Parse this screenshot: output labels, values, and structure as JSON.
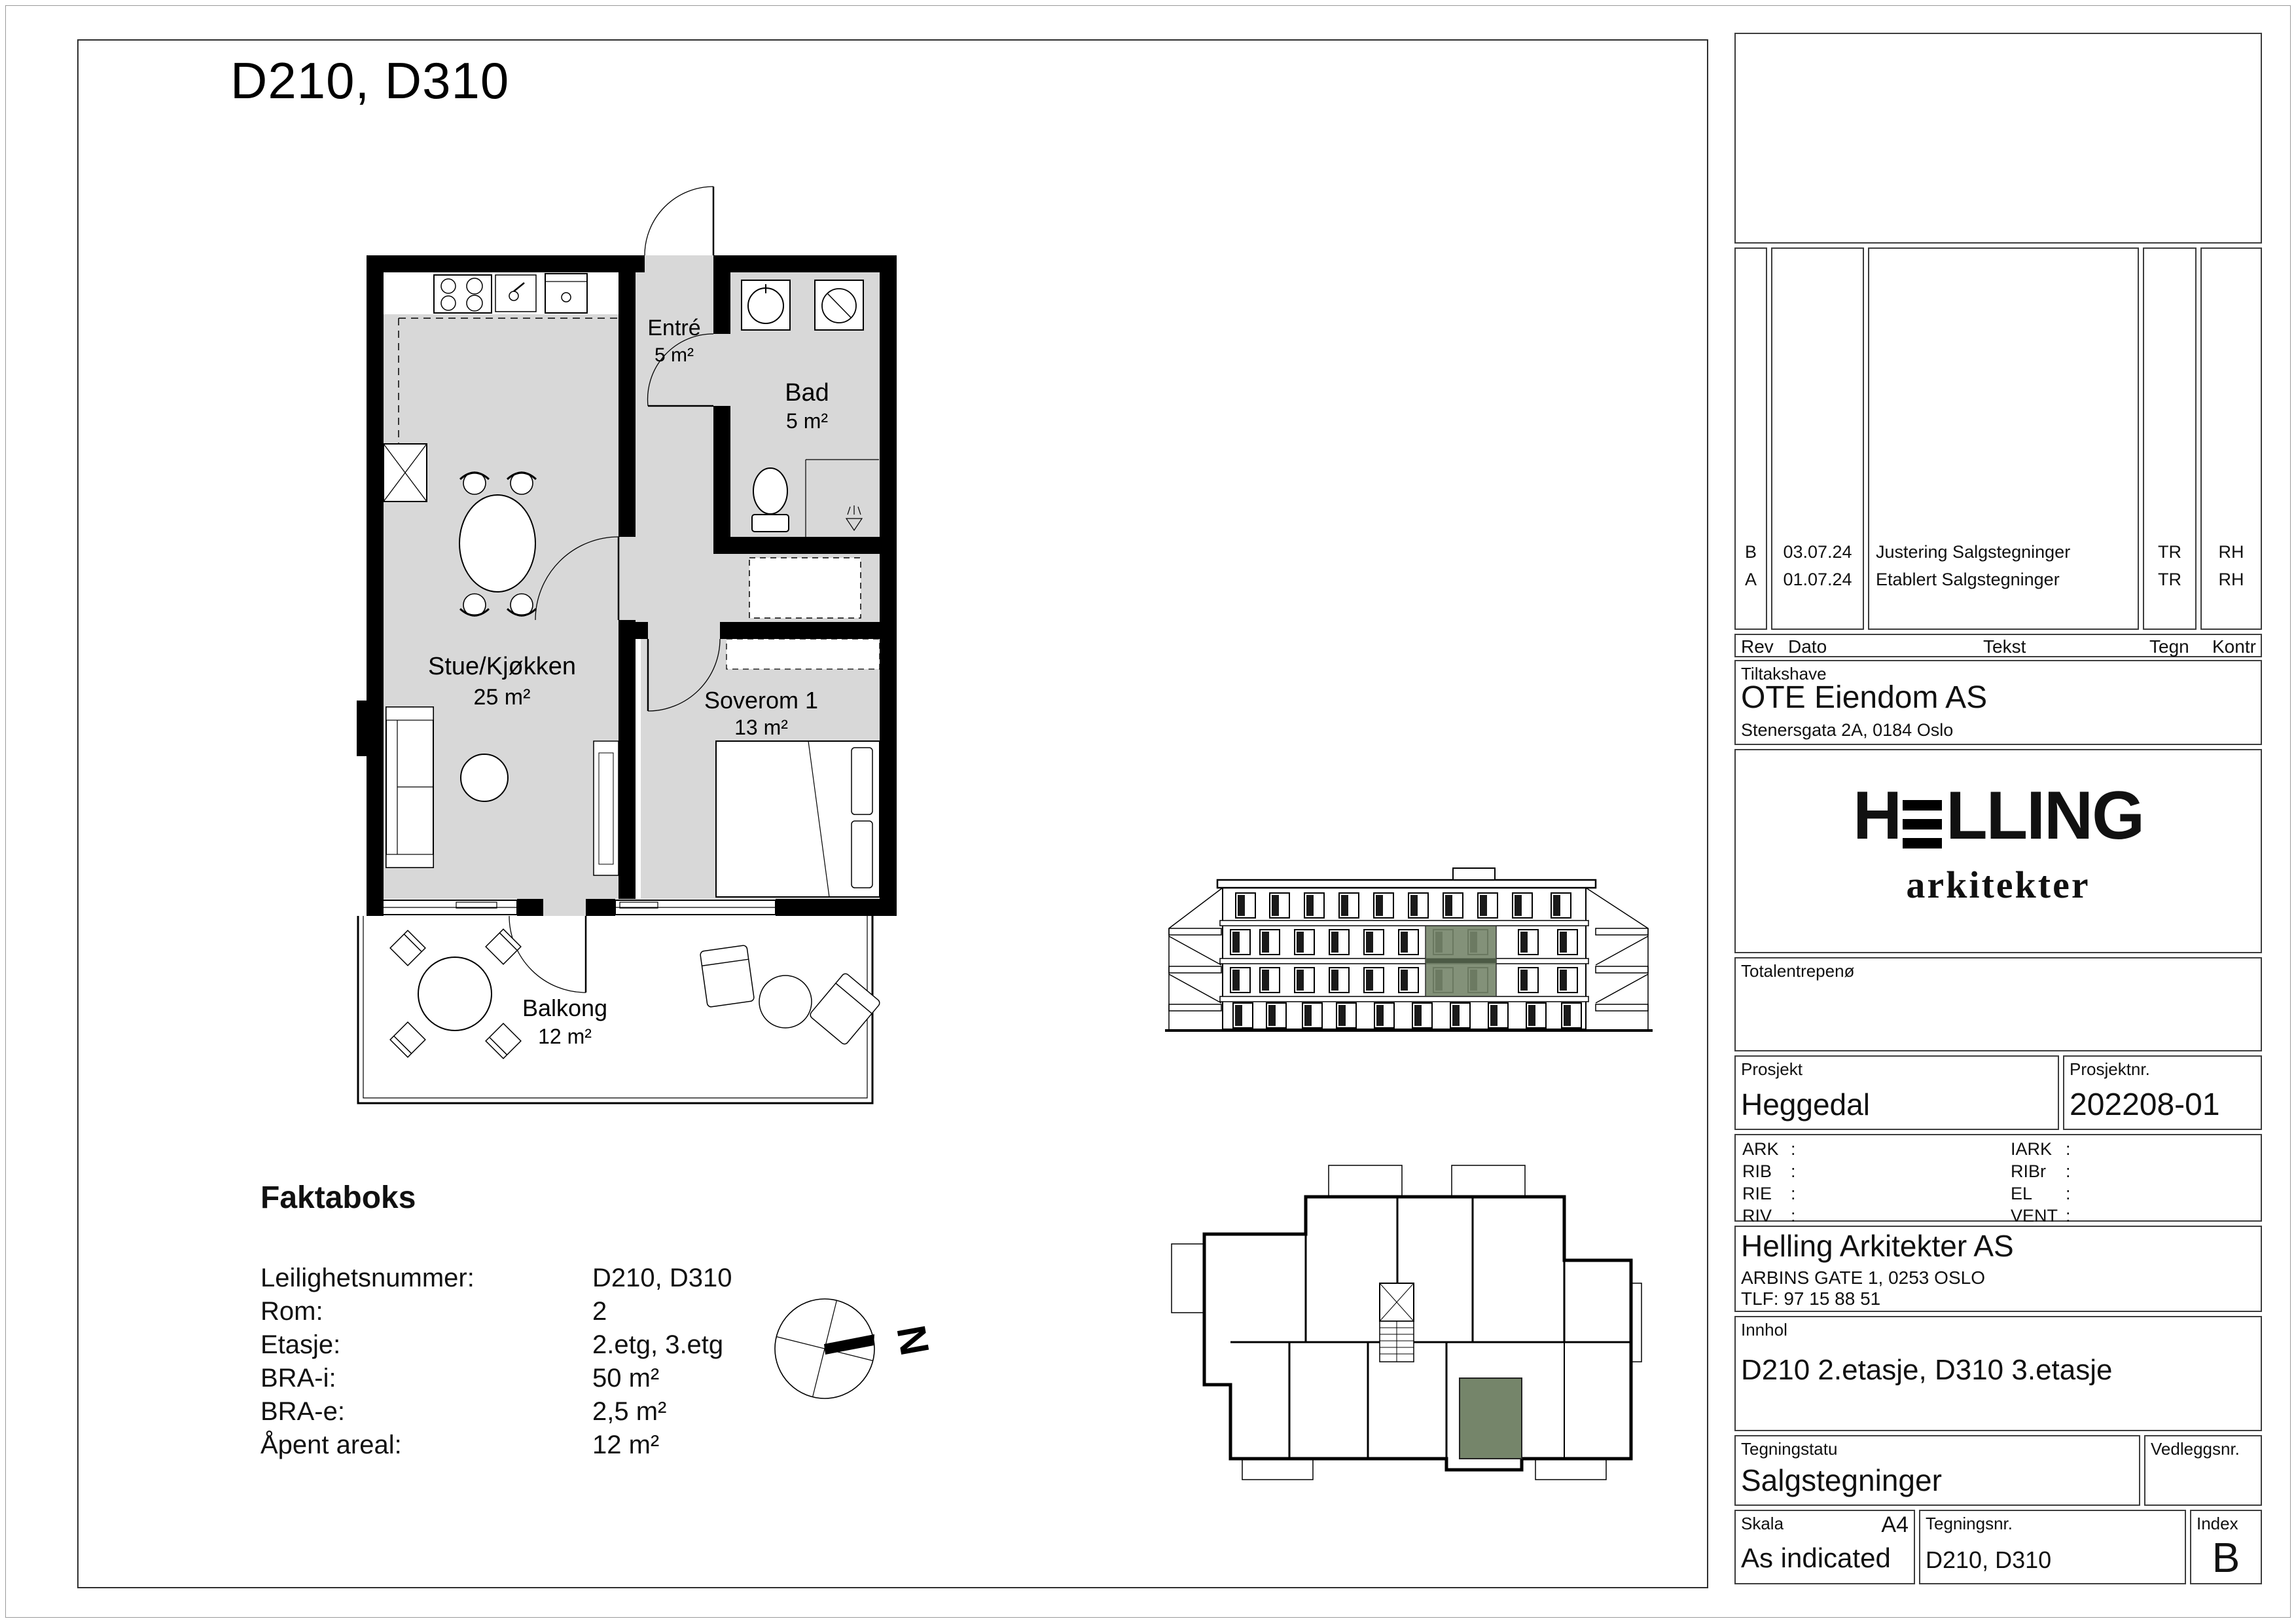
{
  "sheet": {
    "title": "D210, D310"
  },
  "plan": {
    "rooms": [
      {
        "name": "Entré",
        "area": "5 m²"
      },
      {
        "name": "Bad",
        "area": "5 m²"
      },
      {
        "name": "Stue/Kjøkken",
        "area": "25 m²"
      },
      {
        "name": "Soverom 1",
        "area": "13 m²"
      },
      {
        "name": "Balkong",
        "area": "12 m²"
      }
    ]
  },
  "compass": {
    "label": "N"
  },
  "faktaboks": {
    "heading": "Faktaboks",
    "rows": [
      {
        "label": "Leilighetsnummer:",
        "value": "D210, D310"
      },
      {
        "label": "Rom:",
        "value": "2"
      },
      {
        "label": "Etasje:",
        "value": "2.etg, 3.etg"
      },
      {
        "label": "BRA-i:",
        "value": "50 m²"
      },
      {
        "label": "BRA-e:",
        "value": "2,5 m²"
      },
      {
        "label": "Åpent areal:",
        "value": "12 m²"
      }
    ]
  },
  "titleblock": {
    "revisions": [
      {
        "rev": "B",
        "dato": "03.07.24",
        "tekst": "Justering Salgstegninger",
        "tegn": "TR",
        "kontr": "RH"
      },
      {
        "rev": "A",
        "dato": "01.07.24",
        "tekst": "Etablert Salgstegninger",
        "tegn": "TR",
        "kontr": "RH"
      }
    ],
    "rev_headers": {
      "rev": "Rev",
      "dato": "Dato",
      "tekst": "Tekst",
      "tegn": "Tegn",
      "kontr": "Kontr"
    },
    "tiltakshaver": {
      "label": "Tiltakshave",
      "name": "OTE Eiendom AS",
      "address": "Stenersgata 2A, 0184 Oslo"
    },
    "logo": {
      "h": "H",
      "rest": "LLING",
      "sub": "arkitekter"
    },
    "totalentreprenor": {
      "label": "Totalentrepenø"
    },
    "prosjekt": {
      "label": "Prosjekt",
      "value": "Heggedal"
    },
    "prosjektnr": {
      "label": "Prosjektnr.",
      "value": "202208-01"
    },
    "consultants": {
      "left": [
        "ARK",
        "RIB",
        "RIE",
        "RIV"
      ],
      "right": [
        "IARK",
        "RIBr",
        "EL",
        "VENT"
      ],
      "sep": ":"
    },
    "arkitekt": {
      "name": "Helling Arkitekter AS",
      "address": "ARBINS GATE 1, 0253 OSLO",
      "phone": "TLF: 97 15 88 51"
    },
    "innhold": {
      "label": "Innhol",
      "value": "D210 2.etasje, D310 3.etasje"
    },
    "tegningstatus": {
      "label": "Tegningstatu",
      "value": "Salgstegninger"
    },
    "vedleggsnr": {
      "label": "Vedleggsnr."
    },
    "skala": {
      "label": "Skala",
      "paper": "A4",
      "value": "As indicated"
    },
    "tegningsnr": {
      "label": "Tegningsnr.",
      "value": "D210, D310"
    },
    "index": {
      "label": "Index",
      "value": "B"
    }
  },
  "colors": {
    "highlight_green": "#75856a",
    "floor_gray": "#d8d8d8",
    "wall_black": "#000000"
  }
}
